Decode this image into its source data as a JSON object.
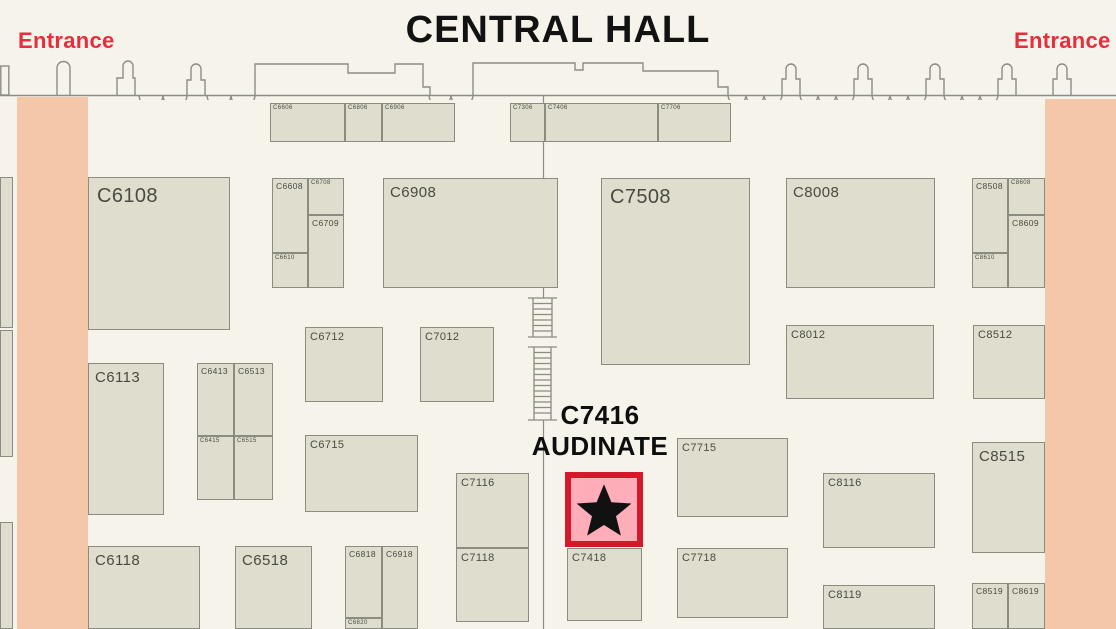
{
  "title": "CENTRAL HALL",
  "entrances": {
    "left_label": "Entrance",
    "right_label": "Entrance"
  },
  "highlight": {
    "booth_id": "C7416",
    "exhibitor": "AUDINATE",
    "marker": "star-icon",
    "x": 565,
    "y": 472,
    "w": 78,
    "h": 75
  },
  "colors": {
    "background": "#f5f3ea",
    "booth_fill": "#deddce",
    "booth_border": "#8b8b80",
    "booth_label": "#4a4a42",
    "entrance_zone": "#f4c7a9",
    "entrance_text": "#e62e3c",
    "highlight_fill": "#ffadb9",
    "highlight_border": "#d6182b",
    "star": "#111111",
    "wall_line": "#8d8d83",
    "title_text": "#121212"
  },
  "entrance_zones": [
    {
      "name": "left",
      "x": 17,
      "y": 97,
      "w": 71,
      "h": 532
    },
    {
      "name": "right",
      "x": 1045,
      "y": 99,
      "w": 71,
      "h": 530
    }
  ],
  "features": [
    "stairs-upper",
    "stairs-lower",
    "center-aisle-line"
  ],
  "booths": [
    {
      "id": "C6606",
      "x": 270,
      "y": 103,
      "w": 75,
      "h": 39,
      "size": "xs"
    },
    {
      "id": "C6806",
      "x": 345,
      "y": 103,
      "w": 37,
      "h": 39,
      "size": "xs"
    },
    {
      "id": "C6906",
      "x": 382,
      "y": 103,
      "w": 73,
      "h": 39,
      "size": "xs"
    },
    {
      "id": "C7306",
      "x": 510,
      "y": 103,
      "w": 35,
      "h": 39,
      "size": "xs"
    },
    {
      "id": "C7406",
      "x": 545,
      "y": 103,
      "w": 113,
      "h": 39,
      "size": "xs"
    },
    {
      "id": "C7706",
      "x": 658,
      "y": 103,
      "w": 73,
      "h": 39,
      "size": "xs"
    },
    {
      "id": "C6108",
      "x": 88,
      "y": 177,
      "w": 142,
      "h": 153,
      "size": "xl"
    },
    {
      "id": "C6608",
      "x": 272,
      "y": 178,
      "w": 36,
      "h": 75,
      "size": "s"
    },
    {
      "id": "C6708",
      "x": 308,
      "y": 178,
      "w": 36,
      "h": 37,
      "size": "xs"
    },
    {
      "id": "C6709",
      "x": 308,
      "y": 215,
      "w": 36,
      "h": 73,
      "size": "s"
    },
    {
      "id": "C6610",
      "x": 272,
      "y": 253,
      "w": 36,
      "h": 35,
      "size": "xs"
    },
    {
      "id": "C6908",
      "x": 383,
      "y": 178,
      "w": 175,
      "h": 110,
      "size": "l"
    },
    {
      "id": "C7508",
      "x": 601,
      "y": 178,
      "w": 149,
      "h": 187,
      "size": "xl"
    },
    {
      "id": "C8008",
      "x": 786,
      "y": 178,
      "w": 149,
      "h": 110,
      "size": "l"
    },
    {
      "id": "C8508",
      "x": 972,
      "y": 178,
      "w": 36,
      "h": 75,
      "size": "s"
    },
    {
      "id": "C8608",
      "x": 1008,
      "y": 178,
      "w": 37,
      "h": 37,
      "size": "xs"
    },
    {
      "id": "C8609",
      "x": 1008,
      "y": 215,
      "w": 37,
      "h": 73,
      "size": "s"
    },
    {
      "id": "C8610",
      "x": 972,
      "y": 253,
      "w": 36,
      "h": 35,
      "size": "xs"
    },
    {
      "id": "C6113",
      "x": 88,
      "y": 363,
      "w": 76,
      "h": 152,
      "size": "l"
    },
    {
      "id": "C6413",
      "x": 197,
      "y": 363,
      "w": 37,
      "h": 73,
      "size": "s"
    },
    {
      "id": "C6513",
      "x": 234,
      "y": 363,
      "w": 39,
      "h": 73,
      "size": "s"
    },
    {
      "id": "C6415",
      "x": 197,
      "y": 436,
      "w": 37,
      "h": 64,
      "size": "xs"
    },
    {
      "id": "C6515",
      "x": 234,
      "y": 436,
      "w": 39,
      "h": 64,
      "size": "xs"
    },
    {
      "id": "C6712",
      "x": 305,
      "y": 327,
      "w": 78,
      "h": 75,
      "size": "m"
    },
    {
      "id": "C7012",
      "x": 420,
      "y": 327,
      "w": 74,
      "h": 75,
      "size": "m"
    },
    {
      "id": "C8012",
      "x": 786,
      "y": 325,
      "w": 148,
      "h": 74,
      "size": "m"
    },
    {
      "id": "C8512",
      "x": 973,
      "y": 325,
      "w": 72,
      "h": 74,
      "size": "m"
    },
    {
      "id": "C6715",
      "x": 305,
      "y": 435,
      "w": 113,
      "h": 77,
      "size": "m"
    },
    {
      "id": "C7116",
      "x": 456,
      "y": 473,
      "w": 73,
      "h": 75,
      "size": "m"
    },
    {
      "id": "C7118",
      "x": 456,
      "y": 548,
      "w": 73,
      "h": 74,
      "size": "m"
    },
    {
      "id": "C7418",
      "x": 567,
      "y": 548,
      "w": 75,
      "h": 73,
      "size": "m"
    },
    {
      "id": "C7715",
      "x": 677,
      "y": 438,
      "w": 111,
      "h": 79,
      "size": "m"
    },
    {
      "id": "C7718",
      "x": 677,
      "y": 548,
      "w": 111,
      "h": 70,
      "size": "m"
    },
    {
      "id": "C8116",
      "x": 823,
      "y": 473,
      "w": 112,
      "h": 75,
      "size": "m"
    },
    {
      "id": "C8515",
      "x": 972,
      "y": 442,
      "w": 73,
      "h": 111,
      "size": "l"
    },
    {
      "id": "C8119",
      "x": 823,
      "y": 585,
      "w": 112,
      "h": 44,
      "size": "m"
    },
    {
      "id": "C8519",
      "x": 972,
      "y": 583,
      "w": 36,
      "h": 46,
      "size": "s"
    },
    {
      "id": "C8619",
      "x": 1008,
      "y": 583,
      "w": 37,
      "h": 46,
      "size": "s"
    },
    {
      "id": "C6118",
      "x": 88,
      "y": 546,
      "w": 112,
      "h": 83,
      "size": "l"
    },
    {
      "id": "C6518",
      "x": 235,
      "y": 546,
      "w": 77,
      "h": 83,
      "size": "l"
    },
    {
      "id": "C6818",
      "x": 345,
      "y": 546,
      "w": 37,
      "h": 72,
      "size": "s"
    },
    {
      "id": "C6918",
      "x": 382,
      "y": 546,
      "w": 36,
      "h": 83,
      "size": "s"
    },
    {
      "id": "C6820",
      "x": 345,
      "y": 618,
      "w": 37,
      "h": 11,
      "size": "xs"
    },
    {
      "id": "",
      "x": 0,
      "y": 177,
      "w": 13,
      "h": 151,
      "size": "xs"
    },
    {
      "id": "",
      "x": 0,
      "y": 330,
      "w": 13,
      "h": 127,
      "size": "xs"
    },
    {
      "id": "",
      "x": 0,
      "y": 522,
      "w": 13,
      "h": 107,
      "size": "xs"
    }
  ]
}
